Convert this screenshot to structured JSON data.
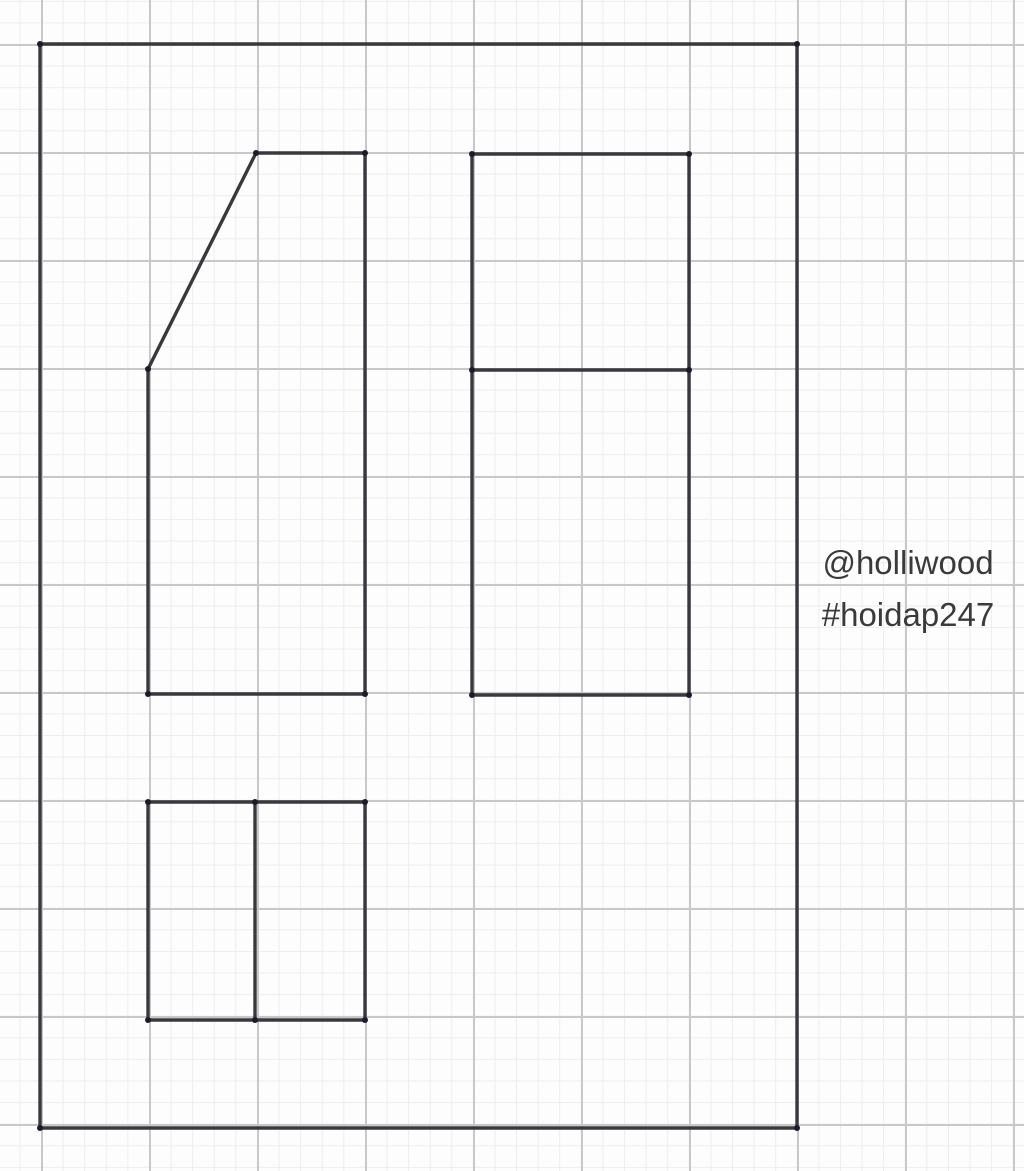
{
  "colors": {
    "background": "#fdfdfd",
    "grid_minor": "#ededee",
    "grid_major": "#c8c8cb",
    "line_color": "#39393d",
    "point_color": "#1b1b2b",
    "text_color": "#3a3a3a"
  },
  "watermark": {
    "line1": "@holliwood",
    "line2": "#hoidap247"
  },
  "drawing": {
    "grid": {
      "minor_step_px": 21.6,
      "major_step_px": 108,
      "origin_x": 41,
      "origin_y": 44
    },
    "point_radius": 3,
    "shapes": [
      {
        "name": "outer-frame",
        "closed": true,
        "points": [
          [
            40,
            44
          ],
          [
            797,
            44
          ],
          [
            797,
            1128
          ],
          [
            40,
            1128
          ]
        ]
      },
      {
        "name": "front-view-pentagon",
        "closed": true,
        "points": [
          [
            256,
            153
          ],
          [
            365,
            153
          ],
          [
            365,
            694
          ],
          [
            148,
            694
          ],
          [
            148,
            369
          ]
        ]
      },
      {
        "name": "side-view-rectangle",
        "closed": true,
        "points": [
          [
            472,
            154
          ],
          [
            689,
            154
          ],
          [
            689,
            695
          ],
          [
            472,
            695
          ]
        ]
      },
      {
        "name": "side-view-divider",
        "closed": false,
        "points": [
          [
            472,
            370
          ],
          [
            689,
            370
          ]
        ]
      },
      {
        "name": "top-view-rectangle",
        "closed": true,
        "points": [
          [
            148,
            802
          ],
          [
            365,
            802
          ],
          [
            365,
            1020
          ],
          [
            148,
            1020
          ]
        ]
      },
      {
        "name": "top-view-divider",
        "closed": false,
        "points": [
          [
            255,
            802
          ],
          [
            255,
            1020
          ]
        ]
      }
    ],
    "vertex_points": [
      [
        40,
        44
      ],
      [
        797,
        44
      ],
      [
        40,
        1128
      ],
      [
        797,
        1128
      ],
      [
        256,
        153
      ],
      [
        365,
        153
      ],
      [
        365,
        694
      ],
      [
        148,
        694
      ],
      [
        148,
        369
      ],
      [
        472,
        154
      ],
      [
        689,
        154
      ],
      [
        689,
        695
      ],
      [
        472,
        695
      ],
      [
        472,
        370
      ],
      [
        689,
        370
      ],
      [
        148,
        802
      ],
      [
        255,
        802
      ],
      [
        365,
        802
      ],
      [
        148,
        1020
      ],
      [
        255,
        1020
      ],
      [
        365,
        1020
      ]
    ]
  }
}
